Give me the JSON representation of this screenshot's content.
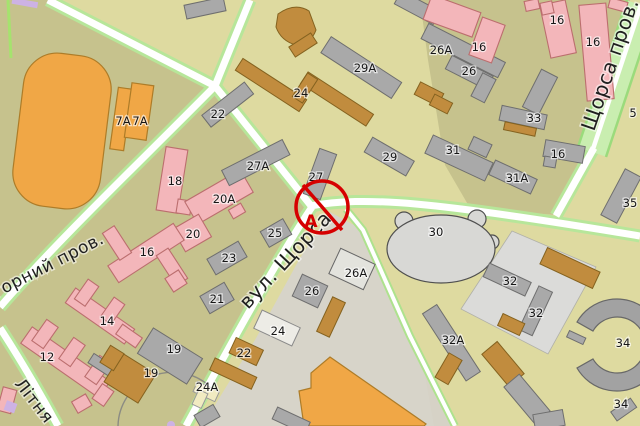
{
  "map": {
    "street_labels": [
      {
        "text": "горний пров.",
        "x": -4,
        "y": 298,
        "angle": -27,
        "size": 17
      },
      {
        "text": "Літня",
        "x": 14,
        "y": 384,
        "angle": 52,
        "size": 17
      },
      {
        "text": "вул. Щорса",
        "x": 248,
        "y": 310,
        "angle": -47,
        "size": 20
      },
      {
        "text": "Щорса пров.",
        "x": 594,
        "y": 132,
        "angle": -71,
        "size": 20
      }
    ],
    "building_labels": [
      {
        "text": "7A",
        "x": 123,
        "y": 125
      },
      {
        "text": "7A",
        "x": 140,
        "y": 125
      },
      {
        "text": "12",
        "x": 47,
        "y": 361
      },
      {
        "text": "14",
        "x": 107,
        "y": 325
      },
      {
        "text": "16",
        "x": 147,
        "y": 256
      },
      {
        "text": "18",
        "x": 175,
        "y": 185
      },
      {
        "text": "19",
        "x": 174,
        "y": 353
      },
      {
        "text": "19",
        "x": 151,
        "y": 377
      },
      {
        "text": "20",
        "x": 193,
        "y": 238
      },
      {
        "text": "20A",
        "x": 224,
        "y": 203
      },
      {
        "text": "21",
        "x": 217,
        "y": 303
      },
      {
        "text": "22",
        "x": 218,
        "y": 118
      },
      {
        "text": "22",
        "x": 244,
        "y": 357
      },
      {
        "text": "23",
        "x": 229,
        "y": 262
      },
      {
        "text": "24",
        "x": 301,
        "y": 97
      },
      {
        "text": "24",
        "x": 278,
        "y": 335
      },
      {
        "text": "24A",
        "x": 207,
        "y": 391
      },
      {
        "text": "25",
        "x": 275,
        "y": 237
      },
      {
        "text": "26",
        "x": 469,
        "y": 75
      },
      {
        "text": "26",
        "x": 312,
        "y": 295
      },
      {
        "text": "26A",
        "x": 441,
        "y": 54
      },
      {
        "text": "26A",
        "x": 356,
        "y": 277
      },
      {
        "text": "27",
        "x": 316,
        "y": 181
      },
      {
        "text": "27A",
        "x": 258,
        "y": 170
      },
      {
        "text": "29",
        "x": 390,
        "y": 161
      },
      {
        "text": "29A",
        "x": 365,
        "y": 72
      },
      {
        "text": "30",
        "x": 436,
        "y": 236
      },
      {
        "text": "31",
        "x": 453,
        "y": 154
      },
      {
        "text": "31A",
        "x": 517,
        "y": 182
      },
      {
        "text": "32",
        "x": 510,
        "y": 285
      },
      {
        "text": "32",
        "x": 536,
        "y": 317
      },
      {
        "text": "32A",
        "x": 453,
        "y": 344
      },
      {
        "text": "33",
        "x": 534,
        "y": 122
      },
      {
        "text": "34",
        "x": 623,
        "y": 347
      },
      {
        "text": "34",
        "x": 621,
        "y": 408
      },
      {
        "text": "35",
        "x": 630,
        "y": 207
      },
      {
        "text": "5",
        "x": 633,
        "y": 117
      },
      {
        "text": "16",
        "x": 479,
        "y": 51
      },
      {
        "text": "16",
        "x": 557,
        "y": 24
      },
      {
        "text": "16",
        "x": 593,
        "y": 46
      },
      {
        "text": "16",
        "x": 558,
        "y": 158
      }
    ],
    "marker": {
      "letter": "A"
    },
    "colors": {
      "bg_pale": "#dedaa0",
      "bg_olive": "#c6c28d",
      "yard": "#d7d4c9",
      "diamond": "#dbdbd9",
      "road_casing": "#b7e69a",
      "road_core": "#ffffff",
      "avenue": "#c9eeb0",
      "avenue_edge": "#9bdb7c",
      "pink": "#f3b6ba",
      "gray": "#a9a9a9",
      "orange": "#f0a746",
      "brown": "#c18c3e",
      "cream": "#f1ebc1",
      "marker": "#d60000",
      "purple": "#cdb2e4"
    }
  }
}
